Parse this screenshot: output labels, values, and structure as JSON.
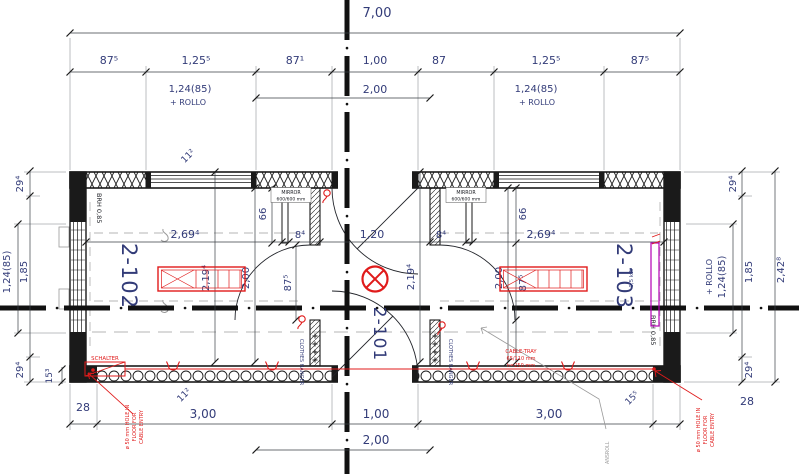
{
  "dims": {
    "top": {
      "total": "7,00",
      "row": [
        "87⁵",
        "1,25⁵",
        "87¹",
        "1,00",
        "87",
        "1,25⁵",
        "87⁵"
      ],
      "center": "2,00",
      "window_note1": "1,24(85)",
      "window_note2": "+ ROLLO"
    },
    "bottom": {
      "left_corner": "28",
      "left_room": "3,00",
      "door": "1,00",
      "right_room": "3,00",
      "right_corner": "28",
      "center": "2,00"
    },
    "left": {
      "wall_top": "29⁴",
      "room": "1,85",
      "window": "1,24(85)",
      "wall_bottom": "29⁴",
      "inset": "15³",
      "corner_top": "11²",
      "corner_bottom": "11²"
    },
    "right": {
      "wall_top": "29⁴",
      "room": "1,85",
      "window": "1,24(85)",
      "rollo": "+ ROLLO",
      "total": "2,42⁸",
      "wall_bottom": "29⁴",
      "corner_bottom": "15⁵"
    },
    "interior": {
      "room_width": "2,69⁴",
      "thin_wall": "8⁴",
      "corridor_width": "1,20",
      "room_depth_a": "2,19⁴",
      "room_depth_b": "2,00",
      "door_width": "87⁵",
      "mirror_wall": "66"
    }
  },
  "rooms": {
    "left": "2-102",
    "center": "2-101",
    "right": "2-103"
  },
  "notes": {
    "brh": "BRH 0,85",
    "mirror_line1": "MIRROR",
    "mirror_line2": "600/600 mm",
    "schalter": "SCHALTER",
    "cable_tray_line1": "CABLE-TRAY",
    "cable_tray_line2": "65/110 mm",
    "cable_tray_line3": "h=250 mm",
    "cable_entry_line1": "ø 50 mm HOLE IN",
    "cable_entry_line2": "FLOOR FOR",
    "cable_entry_line3": "CABLE ENTRY",
    "clothes_hanger": "CLOTHES HANGER",
    "heater_power": "0,5 kW",
    "rollo_leader": "ANSROLL"
  },
  "colors": {
    "wall": "#1a1a1a",
    "dim_text": "#323b78",
    "annotation_red": "#e01b1b",
    "heater_magenta": "#b400b4",
    "leader_gray": "#9a9a9a"
  }
}
